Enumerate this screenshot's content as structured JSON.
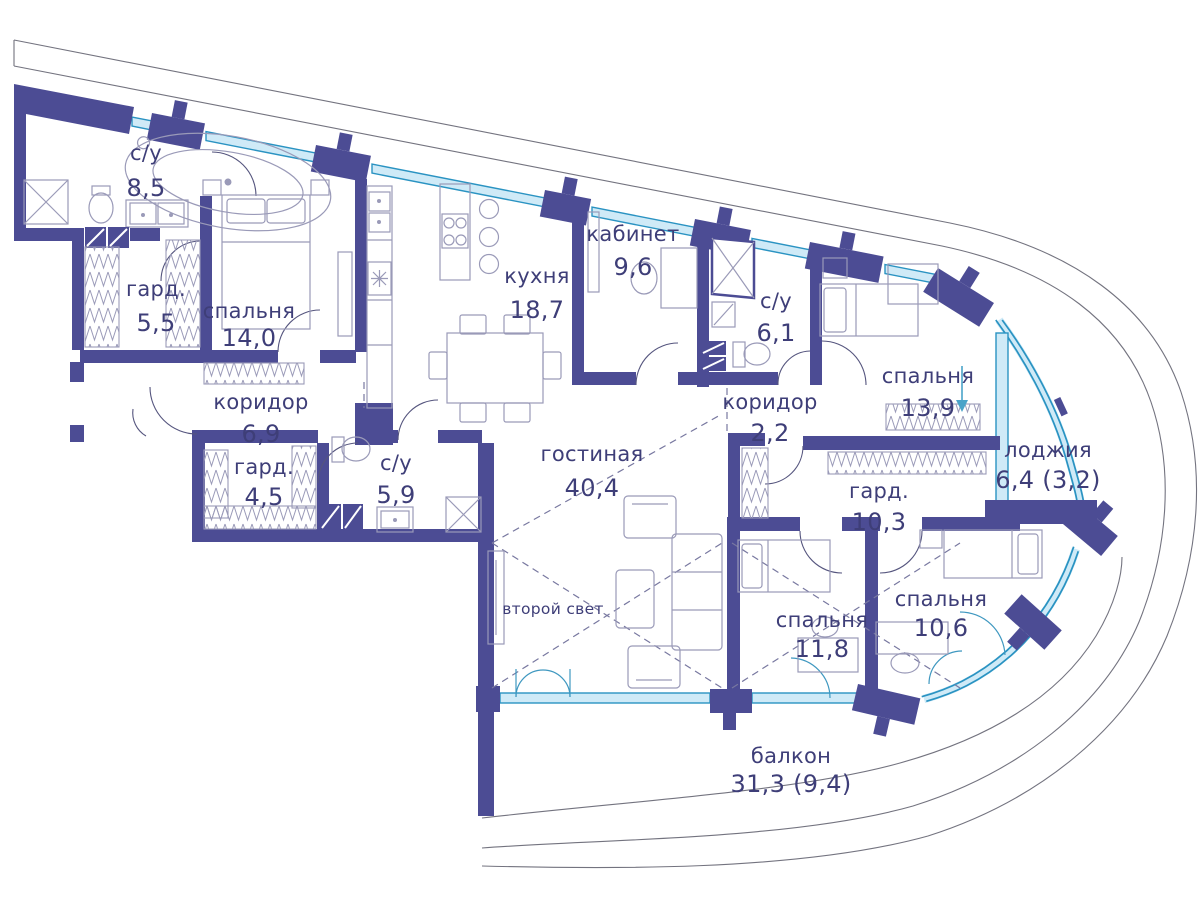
{
  "colors": {
    "wall": "#4c4c94",
    "window_fill": "#cfeaf7",
    "window_line": "#2a93c2",
    "text": "#3e3e78",
    "furniture": "#9a9ab8",
    "boundary": "#73737f",
    "dashed": "#7878a0",
    "door_arc": "#55557e",
    "glass_door_arc": "#3f98c0",
    "arrow": "#4aa3c9"
  },
  "rooms": [
    {
      "id": "bathroom-1",
      "name": "с/у",
      "area": "8,5"
    },
    {
      "id": "wardrobe-1",
      "name": "гард.",
      "area": "5,5"
    },
    {
      "id": "bedroom-1",
      "name": "спальня",
      "area": "14,0"
    },
    {
      "id": "kitchen",
      "name": "кухня",
      "area": "18,7"
    },
    {
      "id": "study",
      "name": "кабинет",
      "area": "9,6"
    },
    {
      "id": "bathroom-2",
      "name": "с/у",
      "area": "6,1"
    },
    {
      "id": "bedroom-2",
      "name": "спальня",
      "area": "13,9"
    },
    {
      "id": "corridor-1",
      "name": "коридор",
      "area": "6,9"
    },
    {
      "id": "wardrobe-2",
      "name": "гард.",
      "area": "4,5"
    },
    {
      "id": "bathroom-3",
      "name": "с/у",
      "area": "5,9"
    },
    {
      "id": "corridor-2",
      "name": "коридор",
      "area": "2,2"
    },
    {
      "id": "living-room",
      "name": "гостиная",
      "area": "40,4"
    },
    {
      "id": "loggia",
      "name": "лоджия",
      "area": "6,4 (3,2)"
    },
    {
      "id": "wardrobe-3",
      "name": "гард.",
      "area": "10,3"
    },
    {
      "id": "bedroom-3",
      "name": "спальня",
      "area": "11,8"
    },
    {
      "id": "bedroom-4",
      "name": "спальня",
      "area": "10,6"
    },
    {
      "id": "balcony",
      "name": "балкон",
      "area": "31,3 (9,4)"
    }
  ],
  "annotations": {
    "second_light": "второй свет"
  },
  "fixtures": [
    "bathtub",
    "shower-cabin",
    "wash-basin",
    "double-vanity",
    "washing-machine",
    "wardrobe-rack",
    "double-bed",
    "single-bed",
    "nightstand",
    "dresser",
    "kitchen-counter",
    "kitchen-sink",
    "refrigerator",
    "island-cooktop",
    "bar-stool",
    "dining-table",
    "chair",
    "desk",
    "office-chair",
    "bookshelf",
    "ventilation-shaft",
    "toilet",
    "sofa",
    "armchair",
    "coffee-table",
    "tv-console",
    "door-swing",
    "window",
    "balcony-railing"
  ]
}
